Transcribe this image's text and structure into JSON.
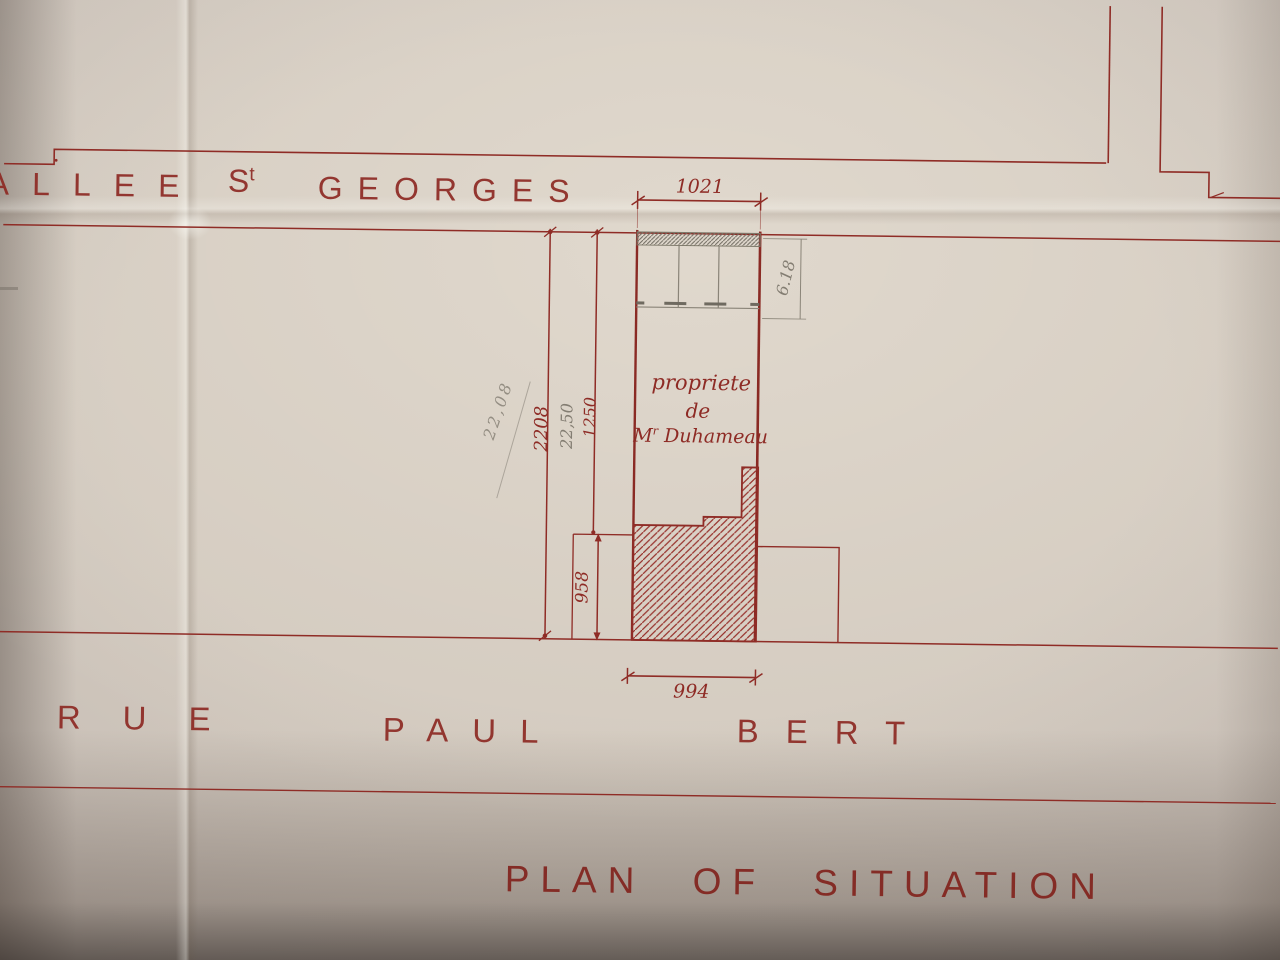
{
  "title": "PLAN OF SITUATION",
  "streets": {
    "allee_st_georges": {
      "word1": "ALLEE",
      "word2_base": "S",
      "word2_sup": "t",
      "word3": "GEORGES"
    },
    "rue_paul_bert": {
      "word1": "RUE",
      "word2": "PAUL",
      "word3": "BERT"
    }
  },
  "property_label": {
    "line1": "propriete",
    "line2": "de",
    "owner_prefix": "M",
    "owner_sup": "r",
    "owner_name": "Duhameau"
  },
  "dimensions": {
    "top_frontage": "1021",
    "bottom_frontage": "994",
    "total_depth_red": "2208",
    "total_depth_pencil": "22,50",
    "courtyard_depth": "1250",
    "building_depth": "958",
    "facade_pencil": "6.18",
    "diagonal_pencil_note": "22,08"
  },
  "colors": {
    "ink_red": "#8e2b25",
    "pencil_gray": "#837d72",
    "paper": "#c9c0b8"
  }
}
